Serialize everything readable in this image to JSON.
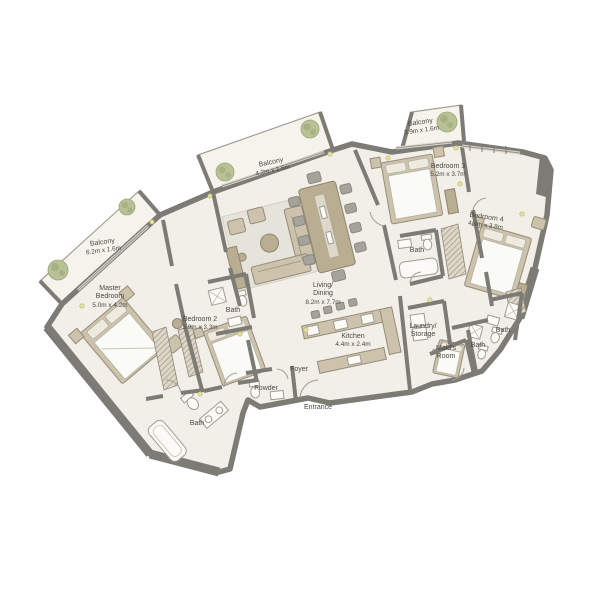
{
  "plan": {
    "type": "apartment-floor-plan",
    "labels": {
      "balcony_left": [
        "Balcony",
        "6.2m x 1.6m"
      ],
      "master_bedroom": [
        "Master",
        "Bedroom",
        "5.0m x 4.2m"
      ],
      "bedroom_2": [
        "Bedroom 2",
        "3.9m x 3.3m"
      ],
      "bath_bedroom_2": [
        "Bath"
      ],
      "balcony_center": [
        "Balcony",
        "4.2m x 1.6m"
      ],
      "living_dining": [
        "Living/",
        "Dining",
        "8.2m x 7.7m"
      ],
      "kitchen": [
        "Kitchen",
        "4.4m x 2.4m"
      ],
      "foyer": [
        "Foyer"
      ],
      "powder": [
        "Powder"
      ],
      "entrance": [
        "Entrance"
      ],
      "bath_master": [
        "Bath"
      ],
      "balcony_right": [
        "Balcony",
        "3.9m x 1.6m"
      ],
      "bedroom_3": [
        "Bedroom 3",
        "5.2m x 3.7m"
      ],
      "bath_bedroom_3": [
        "Bath"
      ],
      "bedroom_4": [
        "Bedroom 4",
        "4.4m x 3.8m"
      ],
      "laundry_storage": [
        "Laundry/",
        "Storage"
      ],
      "maids_room": [
        "Maid's",
        "Room"
      ],
      "bath_maid": [
        "Bath"
      ],
      "bath_bedroom_4": [
        "Bath"
      ]
    },
    "colors": {
      "wall": "#7d7b75",
      "floor": "#f2efe8",
      "balconyFloor": "#f6f3ec",
      "furnTan": "#cdc3ac",
      "chairGray": "#a6a39b",
      "rug": "#e6e3da",
      "fixture": "#fbfaf7",
      "plant": "#b9c196",
      "dot": "#e3e19b",
      "text": "#4a4843"
    },
    "icons": {
      "plant": "plant-icon",
      "bed": "bed-icon",
      "bathtub": "bathtub-icon",
      "toilet": "toilet-icon",
      "sink": "sink-icon",
      "shower": "shower-icon",
      "sofa": "sofa-icon",
      "dining_table": "dining-table-icon",
      "kitchen_counter": "kitchen-counter-icon",
      "wardrobe": "wardrobe-icon",
      "washer": "washer-icon"
    }
  }
}
